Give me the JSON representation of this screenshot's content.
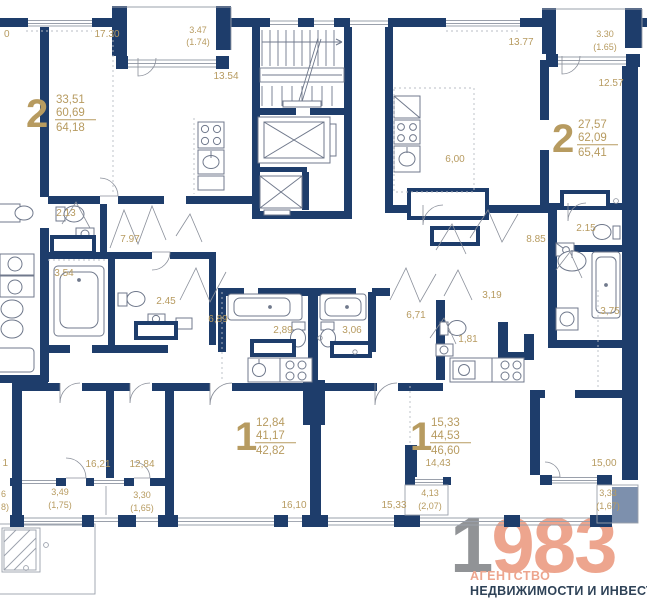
{
  "colors": {
    "wall": "#1e3d6b",
    "light_wall": "#7d90ad",
    "label_gold": "#b79b60",
    "fixture_gray": "#70798c",
    "logo_gray": "#919396",
    "logo_salmon": "#eda58e",
    "logo_navy": "#2e4257"
  },
  "apartments": [
    {
      "rooms": "2",
      "living": "33,51",
      "area": "60,69",
      "total": "64,18"
    },
    {
      "rooms": "2",
      "living": "27,57",
      "area": "62,09",
      "total": "65,41"
    },
    {
      "rooms": "1",
      "living": "12,84",
      "area": "41,17",
      "total": "42,82"
    },
    {
      "rooms": "1",
      "living": "15,33",
      "area": "44,53",
      "total": "46,60"
    }
  ],
  "room_labels": {
    "edge_top": "0",
    "r17_30": "17.30",
    "balc1": "3.47",
    "balc1_k": "(1.74)",
    "r13_54": "13.54",
    "r13_77": "13.77",
    "balc2": "3.30",
    "balc2_k": "(1.65)",
    "r12_57": "12.57",
    "k6_00": "6,00",
    "wc2_13": "2.13",
    "hall7_97": "7.97",
    "bath3_54": "3.54",
    "hall8_85": "8.85",
    "wc2_15": "2.15",
    "wc2_45": "2.45",
    "hall6_89": "6,89",
    "bath2_89": "2,89",
    "bath3_06": "3,06",
    "hall6_71": "6,71",
    "hall3_19": "3,19",
    "bath3_75": "3,75",
    "wc1_81": "1,81",
    "r16_21": "16,21",
    "r12_84": "12,84",
    "balc3": "3,49",
    "balc3_k": "(1,75)",
    "balc4": "3,30",
    "balc4_k": "(1,65)",
    "r16_10": "16,10",
    "r15_33": "15,33",
    "r14_43": "14,43",
    "balc5": "4,13",
    "balc5_k": "(2,07)",
    "r15_00": "15,00",
    "balc6": "3,33",
    "balc6_k": "(1,67)",
    "edge_mid": "1",
    "edge_low1": "6",
    "edge_low2": "8)"
  },
  "logo": {
    "digit_gray": "1",
    "digits_salmon": "983",
    "line1": "АГЕНТСТВО",
    "line2": "НЕДВИЖИМОСТИ И ИНВЕСТИЦИЙ"
  }
}
